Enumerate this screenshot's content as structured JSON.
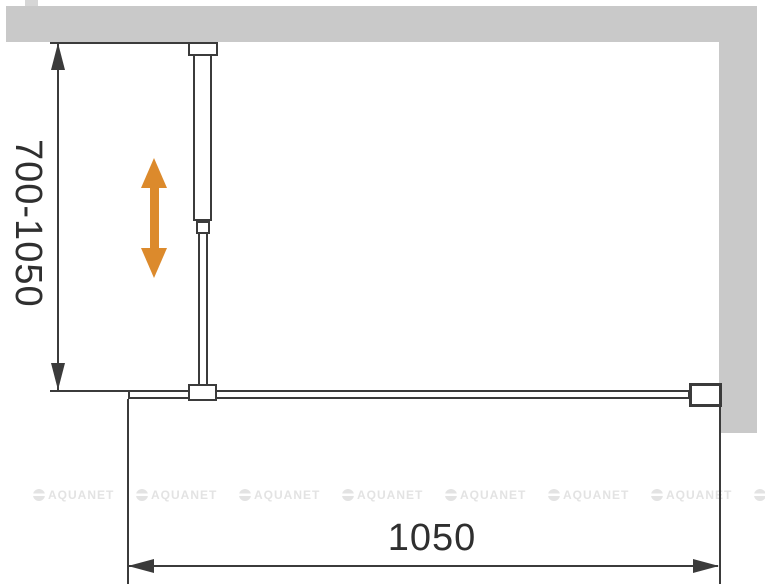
{
  "diagram": {
    "left_dimension": {
      "label": "700-1050"
    },
    "bottom_dimension": {
      "label": "1050"
    },
    "watermark": {
      "text": "AQUANET",
      "count": 8
    },
    "colors": {
      "wall": "#C9C9C9",
      "line": "#3B3B3B",
      "adjustment_arrow": "#DC8A2C",
      "watermark": "#E3E3E3",
      "background": "#FFFFFF"
    }
  }
}
